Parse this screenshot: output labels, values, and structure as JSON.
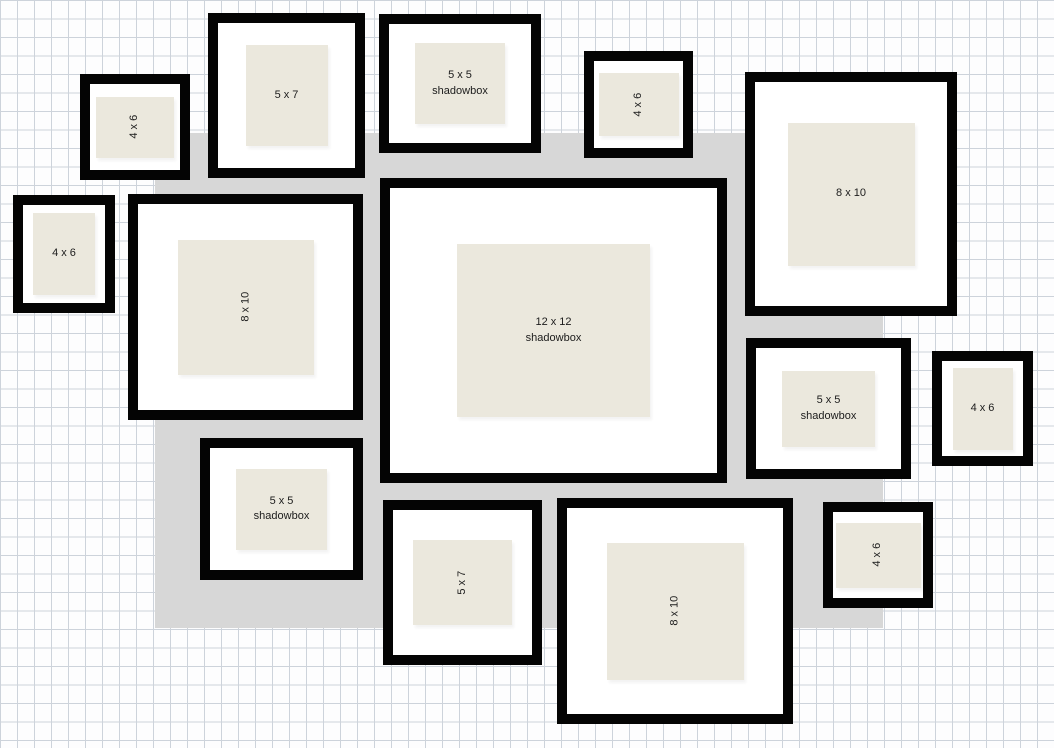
{
  "app": {
    "title": "Gallery wall frame layout"
  },
  "colors": {
    "canvas": "#fdfdfe",
    "grid_line": "#cdd3db",
    "backdrop_gray": "#d7d7d7",
    "frame_black": "#040404",
    "mat_white": "#ffffff",
    "photo_beige": "#ebe8dd",
    "label_text": "#1c1c1c"
  },
  "backdrop": {
    "x": 155,
    "y": 133,
    "w": 728,
    "h": 495,
    "color": "#d7d7d7"
  },
  "frames": [
    {
      "id": "4x6-top-left",
      "size": "4 x 6",
      "style": "frame",
      "lines": [
        "4 x 6"
      ],
      "rotated": true,
      "x": 80,
      "y": 74,
      "w": 110,
      "h": 106,
      "pw": 78,
      "ph": 61
    },
    {
      "id": "5x7-top",
      "size": "5 x 7",
      "style": "frame",
      "lines": [
        "5 x 7"
      ],
      "rotated": false,
      "x": 208,
      "y": 13,
      "w": 157,
      "h": 165,
      "pw": 82,
      "ph": 101
    },
    {
      "id": "5x5-shadowbox-top",
      "size": "5 x 5",
      "style": "shadowbox",
      "lines": [
        "5 x 5",
        "shadowbox"
      ],
      "rotated": false,
      "x": 379,
      "y": 14,
      "w": 162,
      "h": 139,
      "pw": 90,
      "ph": 81
    },
    {
      "id": "4x6-top-center",
      "size": "4 x 6",
      "style": "frame",
      "lines": [
        "4 x 6"
      ],
      "rotated": true,
      "x": 584,
      "y": 51,
      "w": 109,
      "h": 107,
      "pw": 80,
      "ph": 63
    },
    {
      "id": "8x10-top-right",
      "size": "8 x 10",
      "style": "frame",
      "lines": [
        "8 x 10"
      ],
      "rotated": false,
      "x": 745,
      "y": 72,
      "w": 212,
      "h": 244,
      "pw": 127,
      "ph": 143
    },
    {
      "id": "4x6-left",
      "size": "4 x 6",
      "style": "frame",
      "lines": [
        "4 x 6"
      ],
      "rotated": false,
      "x": 13,
      "y": 195,
      "w": 102,
      "h": 118,
      "pw": 62,
      "ph": 82
    },
    {
      "id": "8x10-left",
      "size": "8 x 10",
      "style": "frame",
      "lines": [
        "8 x 10"
      ],
      "rotated": true,
      "x": 128,
      "y": 194,
      "w": 235,
      "h": 226,
      "pw": 136,
      "ph": 135
    },
    {
      "id": "12x12-shadowbox-center",
      "size": "12 x 12",
      "style": "shadowbox",
      "lines": [
        "12 x 12",
        "shadowbox"
      ],
      "rotated": false,
      "x": 380,
      "y": 178,
      "w": 347,
      "h": 305,
      "pw": 193,
      "ph": 173
    },
    {
      "id": "5x5-shadowbox-right",
      "size": "5 x 5",
      "style": "shadowbox",
      "lines": [
        "5 x 5",
        "shadowbox"
      ],
      "rotated": false,
      "x": 746,
      "y": 338,
      "w": 165,
      "h": 141,
      "pw": 93,
      "ph": 76
    },
    {
      "id": "4x6-right",
      "size": "4 x 6",
      "style": "frame",
      "lines": [
        "4 x 6"
      ],
      "rotated": false,
      "x": 932,
      "y": 351,
      "w": 101,
      "h": 115,
      "pw": 60,
      "ph": 82
    },
    {
      "id": "5x5-shadowbox-bottom-left",
      "size": "5 x 5",
      "style": "shadowbox",
      "lines": [
        "5 x 5",
        "shadowbox"
      ],
      "rotated": false,
      "x": 200,
      "y": 438,
      "w": 163,
      "h": 142,
      "pw": 91,
      "ph": 81
    },
    {
      "id": "5x7-bottom",
      "size": "5 x 7",
      "style": "frame",
      "lines": [
        "5 x 7"
      ],
      "rotated": true,
      "x": 383,
      "y": 500,
      "w": 159,
      "h": 165,
      "pw": 99,
      "ph": 85
    },
    {
      "id": "8x10-bottom",
      "size": "8 x 10",
      "style": "frame",
      "lines": [
        "8 x 10"
      ],
      "rotated": true,
      "x": 557,
      "y": 498,
      "w": 236,
      "h": 226,
      "pw": 137,
      "ph": 137
    },
    {
      "id": "4x6-bottom-right",
      "size": "4 x 6",
      "style": "frame",
      "lines": [
        "4 x 6"
      ],
      "rotated": true,
      "x": 823,
      "y": 502,
      "w": 110,
      "h": 106,
      "pw": 85,
      "ph": 65
    }
  ]
}
